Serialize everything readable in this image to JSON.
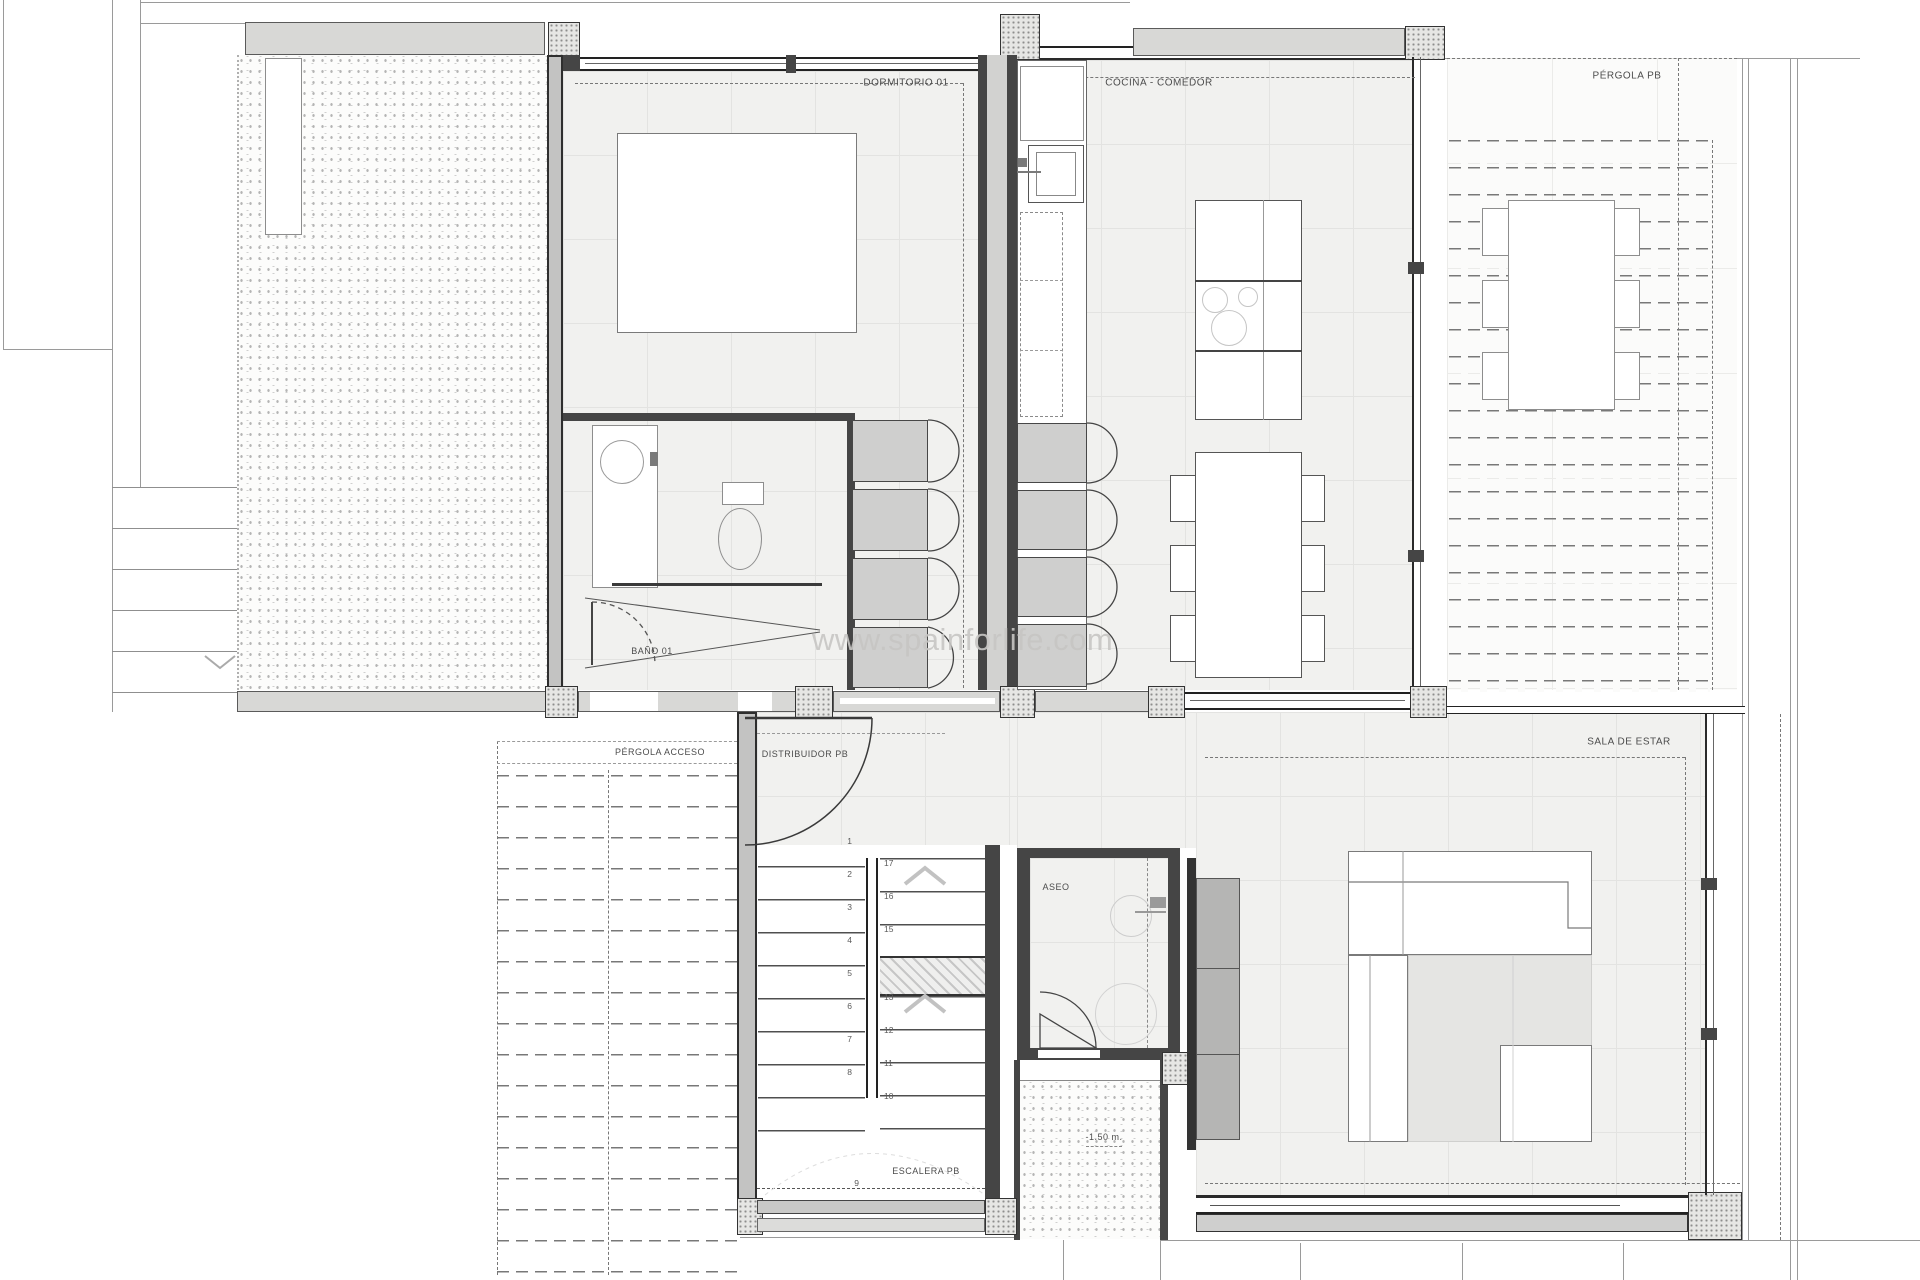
{
  "watermark": "www.spainforlife.com",
  "rooms": {
    "dormitorio": "DORMITORIO 01",
    "cocina": "COCINA - COMEDOR",
    "pergola_pb": "PÉRGOLA PB",
    "bano": "BAÑO 01",
    "pergola_acceso": "PÉRGOLA ACCESO",
    "distribuidor": "DISTRIBUIDOR PB",
    "sala_de_estar": "SALA DE ESTAR",
    "aseo": "ASEO",
    "escalera": "ESCALERA PB"
  },
  "annotations": {
    "level_mark": "-1.50 m."
  },
  "stairs": {
    "flight_left": [
      "1",
      "2",
      "3",
      "4",
      "5",
      "6",
      "7",
      "8"
    ],
    "flight_right_upper": [
      "17",
      "16",
      "15"
    ],
    "flight_right_lower": [
      "13",
      "12",
      "11",
      "10"
    ],
    "bottom_step": "9"
  }
}
